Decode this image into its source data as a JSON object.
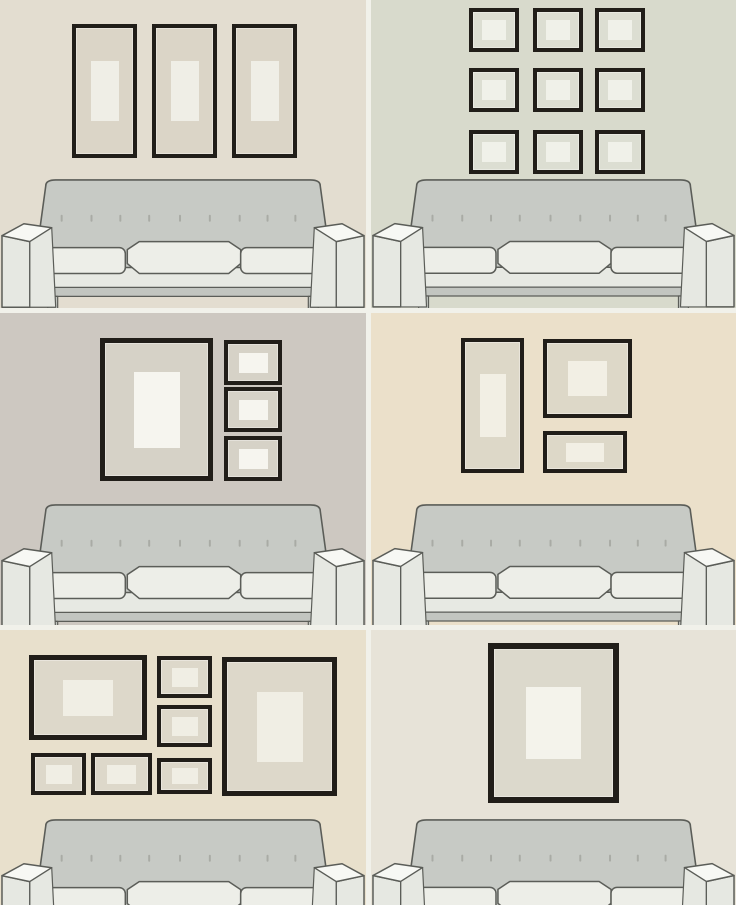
{
  "title": "gallery-wall-arrangements-above-sofa",
  "grid": {
    "columns": 2,
    "rows": 3,
    "divider_color": "#f1f1ea"
  },
  "frame_border_color": "#211e19",
  "sofa_colors": {
    "back": "#c7cac5",
    "cushion": "#edeee8",
    "apron": "#e7e9e3",
    "rail": "#c2c5c0",
    "armtop": "#f7f8f4",
    "armface": "#e6e8e2",
    "line": "#5b5d58",
    "button": "#a9aba5"
  },
  "panels": [
    {
      "name": "three-vertical-frames",
      "wall": "#e3ddd0",
      "mat": "#dbd5c7",
      "picture": "#efeee6",
      "sofa_top": 176,
      "frames": [
        {
          "x": 72,
          "y": 24,
          "w": 65,
          "h": 134,
          "b": 4,
          "iw": 0.43,
          "ih": 0.45
        },
        {
          "x": 152,
          "y": 24,
          "w": 65,
          "h": 134,
          "b": 4,
          "iw": 0.43,
          "ih": 0.45
        },
        {
          "x": 232,
          "y": 24,
          "w": 65,
          "h": 134,
          "b": 4,
          "iw": 0.43,
          "ih": 0.45
        }
      ]
    },
    {
      "name": "nine-square-grid",
      "wall": "#d8dacc",
      "mat": "#dcded2",
      "picture": "#f0f1e9",
      "sofa_top": 176,
      "frames": [
        {
          "x": 98,
          "y": 8,
          "w": 50,
          "h": 44,
          "b": 4,
          "iw": 0.48,
          "ih": 0.45
        },
        {
          "x": 162,
          "y": 8,
          "w": 50,
          "h": 44,
          "b": 4,
          "iw": 0.48,
          "ih": 0.45
        },
        {
          "x": 224,
          "y": 8,
          "w": 50,
          "h": 44,
          "b": 4,
          "iw": 0.48,
          "ih": 0.45
        },
        {
          "x": 98,
          "y": 68,
          "w": 50,
          "h": 44,
          "b": 4,
          "iw": 0.48,
          "ih": 0.45
        },
        {
          "x": 162,
          "y": 68,
          "w": 50,
          "h": 44,
          "b": 4,
          "iw": 0.48,
          "ih": 0.45
        },
        {
          "x": 224,
          "y": 68,
          "w": 50,
          "h": 44,
          "b": 4,
          "iw": 0.48,
          "ih": 0.45
        },
        {
          "x": 98,
          "y": 130,
          "w": 50,
          "h": 44,
          "b": 4,
          "iw": 0.48,
          "ih": 0.45
        },
        {
          "x": 162,
          "y": 130,
          "w": 50,
          "h": 44,
          "b": 4,
          "iw": 0.48,
          "ih": 0.45
        },
        {
          "x": 224,
          "y": 130,
          "w": 50,
          "h": 44,
          "b": 4,
          "iw": 0.48,
          "ih": 0.45
        }
      ]
    },
    {
      "name": "large-frame-with-three-side-frames",
      "wall": "#cdc8c1",
      "mat": "#d6d2c7",
      "picture": "#f6f5ef",
      "sofa_top": 188,
      "frames": [
        {
          "x": 100,
          "y": 25,
          "w": 113,
          "h": 143,
          "b": 5,
          "iw": 0.41,
          "ih": 0.53
        },
        {
          "x": 224,
          "y": 27,
          "w": 58,
          "h": 45,
          "b": 4,
          "iw": 0.5,
          "ih": 0.45
        },
        {
          "x": 224,
          "y": 74,
          "w": 58,
          "h": 45,
          "b": 4,
          "iw": 0.5,
          "ih": 0.45
        },
        {
          "x": 224,
          "y": 123,
          "w": 58,
          "h": 45,
          "b": 4,
          "iw": 0.5,
          "ih": 0.45
        }
      ]
    },
    {
      "name": "asymmetric-trio",
      "wall": "#ebe0ca",
      "mat": "#ddd8c8",
      "picture": "#f2efe4",
      "sofa_top": 188,
      "frames": [
        {
          "x": 90,
          "y": 25,
          "w": 63,
          "h": 135,
          "b": 4,
          "iw": 0.42,
          "ih": 0.47
        },
        {
          "x": 172,
          "y": 26,
          "w": 89,
          "h": 79,
          "b": 4,
          "iw": 0.44,
          "ih": 0.44
        },
        {
          "x": 172,
          "y": 118,
          "w": 84,
          "h": 42,
          "b": 4,
          "iw": 0.45,
          "ih": 0.45
        }
      ]
    },
    {
      "name": "gallery-collage",
      "wall": "#e8e0cc",
      "mat": "#ddd8ca",
      "picture": "#f0eee4",
      "sofa_top": 186,
      "frames": [
        {
          "x": 29,
          "y": 25,
          "w": 118,
          "h": 85,
          "b": 5,
          "iw": 0.42,
          "ih": 0.42
        },
        {
          "x": 157,
          "y": 26,
          "w": 55,
          "h": 42,
          "b": 4,
          "iw": 0.48,
          "ih": 0.45
        },
        {
          "x": 157,
          "y": 75,
          "w": 55,
          "h": 42,
          "b": 4,
          "iw": 0.48,
          "ih": 0.45
        },
        {
          "x": 157,
          "y": 128,
          "w": 55,
          "h": 36,
          "b": 4,
          "iw": 0.48,
          "ih": 0.45
        },
        {
          "x": 31,
          "y": 123,
          "w": 55,
          "h": 42,
          "b": 4,
          "iw": 0.48,
          "ih": 0.45
        },
        {
          "x": 91,
          "y": 123,
          "w": 61,
          "h": 42,
          "b": 4,
          "iw": 0.48,
          "ih": 0.45
        },
        {
          "x": 222,
          "y": 27,
          "w": 115,
          "h": 139,
          "b": 5,
          "iw": 0.4,
          "ih": 0.5
        }
      ]
    },
    {
      "name": "single-statement-frame",
      "wall": "#e7e3d8",
      "mat": "#dcd9cc",
      "picture": "#f4f3eb",
      "sofa_top": 186,
      "frames": [
        {
          "x": 117,
          "y": 13,
          "w": 131,
          "h": 160,
          "b": 6,
          "iw": 0.42,
          "ih": 0.45
        }
      ]
    }
  ]
}
